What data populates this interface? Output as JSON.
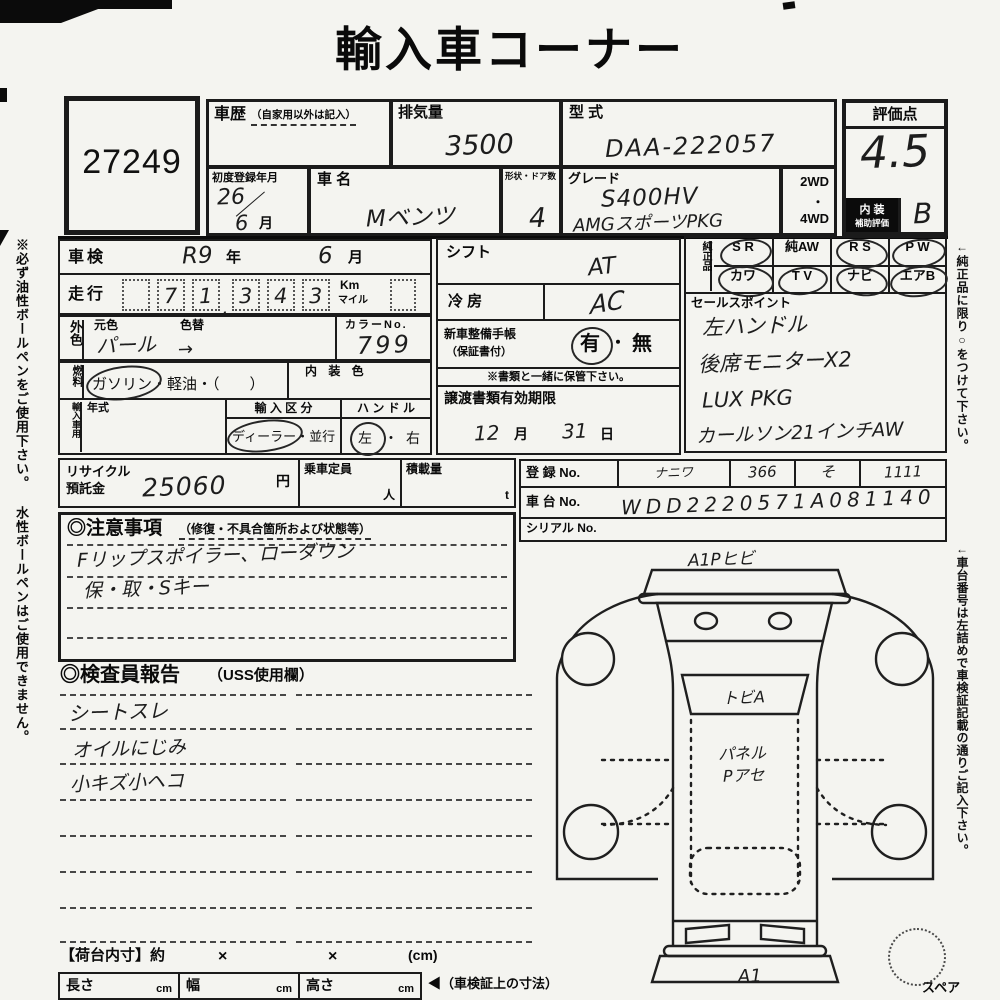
{
  "title": "輸入車コーナー",
  "lot": "27249",
  "header": {
    "history_label": "車歴",
    "history_note": "（自家用以外は記入）",
    "displacement_label": "排気量",
    "displacement_value": "3500",
    "model_code_label": "型 式",
    "model_code_value": "DAA-222057",
    "first_reg_label": "初度登録年月",
    "first_reg_year": "26",
    "first_reg_slash": "／",
    "first_reg_month": "6",
    "first_reg_month_suffix": "月",
    "name_label": "車 名",
    "name_value": "Mベンツ",
    "shape_doors_label": "形状・ドア数",
    "shape_doors_value": "4",
    "grade_label": "グレード",
    "grade_line1": "S400HV",
    "grade_line2": "AMGスポーツPKG",
    "drive_2wd": "2WD",
    "drive_dot": "・",
    "drive_4wd": "4WD"
  },
  "rating": {
    "label": "評価点",
    "score": "4.5",
    "interior_label1": "内 装",
    "interior_label2": "補助評価",
    "interior_score": "B"
  },
  "inspection": {
    "label": "車検",
    "year": "R9",
    "year_suffix": "年",
    "month": "6",
    "month_suffix": "月"
  },
  "mileage": {
    "label": "走行",
    "d1": "",
    "d2": "7",
    "d3": "1",
    "comma": ",",
    "d4": "3",
    "d5": "4",
    "d6": "3",
    "unit_top": "Km",
    "unit_bottom": "マイル"
  },
  "color": {
    "tab": "外色",
    "base_label": "元色",
    "repaint_label": "色替",
    "base_value": "パール",
    "arrow": "→",
    "no_label": "カラーNo.",
    "no_value": "799"
  },
  "fuel": {
    "tab": "燃料",
    "opt1": "ガソリン",
    "sep": "・",
    "opt2": "軽油",
    "paren": "・（　　）",
    "interior_color_label": "内 装 色"
  },
  "import": {
    "tab": "輸入車用",
    "year_label": "年式",
    "type_label": "輸 入 区 分",
    "type_opt1": "ディーラー",
    "type_dot": "・",
    "type_opt2": "並行",
    "handle_label": "ハ ン ド ル",
    "handle_opt1": "左",
    "handle_dot": "・",
    "handle_opt2": "右"
  },
  "shift": {
    "label": "シフト",
    "value": "AT"
  },
  "ac": {
    "label": "冷 房",
    "value": "AC"
  },
  "service_book": {
    "label1": "新車整備手帳",
    "label2": "（保証書付）",
    "yes": "有",
    "dot": "・",
    "no": "無",
    "note": "※書類と一緒に保管下さい。"
  },
  "transfer": {
    "label": "譲渡書類有効期限",
    "month": "12",
    "month_suffix": "月",
    "day": "31",
    "day_suffix": "日"
  },
  "genuine": {
    "label": "純正品",
    "items": [
      {
        "label": "S R",
        "circled": true
      },
      {
        "label": "純AW",
        "circled": false
      },
      {
        "label": "R S",
        "circled": true
      },
      {
        "label": "P W",
        "circled": true
      },
      {
        "label": "カワ",
        "circled": true
      },
      {
        "label": "T V",
        "circled": true
      },
      {
        "label": "ナビ",
        "circled": true
      },
      {
        "label": "エアB",
        "circled": true
      }
    ]
  },
  "sales": {
    "label": "セールスポイント",
    "line1": "左ハンドル",
    "line2": "後席モニターX2",
    "line3": "LUX PKG",
    "line4": "カールソン21インチAW"
  },
  "recycle": {
    "label1": "リサイクル",
    "label2": "預託金",
    "value": "25060",
    "unit": "円",
    "capacity_label": "乗車定員",
    "capacity_unit": "人",
    "load_label": "積載量",
    "load_unit": "t"
  },
  "registration": {
    "reg_label": "登 録 No.",
    "reg1": "ナニワ",
    "reg2": "366",
    "reg3": "そ",
    "reg4": "1111",
    "chassis_label": "車 台 No.",
    "chassis_value": "WDD2220571A081140",
    "serial_label": "シリアル No."
  },
  "cautions": {
    "label": "◎注意事項",
    "note": "（修復・不具合箇所および状態等）",
    "line1": "Fリップスポイラー、ローダウン",
    "line2": "保・取・Sキー"
  },
  "inspector": {
    "label": "◎検査員報告",
    "note": "（USS使用欄）",
    "line1": "シートスレ",
    "line2": "オイルにじみ",
    "line3": "小キズ小ヘコ"
  },
  "diagram": {
    "top_note": "A1Pヒビ",
    "windshield_note": "トビA",
    "roof_note1": "パネル",
    "roof_note2": "Pアセ",
    "bottom_note": "A1",
    "spare_label": "スペア"
  },
  "cargo": {
    "label": "【荷台内寸】約",
    "x1": "×",
    "x2": "×",
    "unit": "(cm)",
    "length_label": "長さ",
    "length_unit": "cm",
    "width_label": "幅",
    "width_unit": "cm",
    "height_label": "高さ",
    "height_unit": "cm",
    "ref_note": "◀（車検証上の寸法）"
  },
  "margin_notes": {
    "left": "※必ず油性ボールペンをご使用下さい。 水性ボールペンはご使用できません。",
    "right1": "←純正品に限り○をつけて下さい。",
    "right2": "←車台番号は左詰めで車検証記載の通りご記入下さい。"
  }
}
